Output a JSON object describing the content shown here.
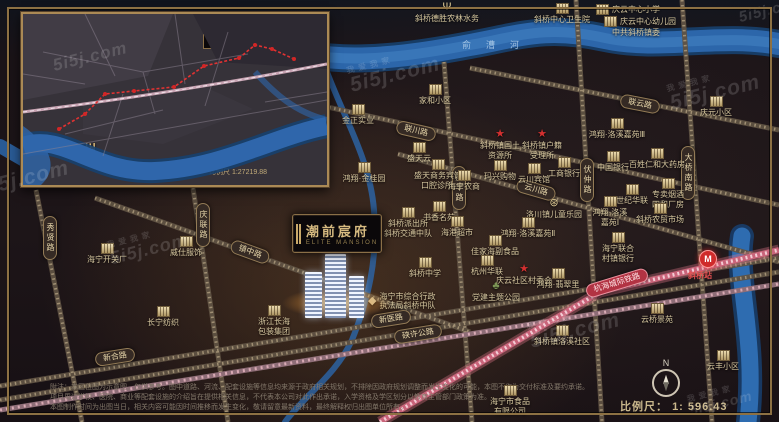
{
  "watermark": {
    "text": "5i5j.com",
    "cn": "我爱我家"
  },
  "inset": {
    "city_top": "海宁",
    "city_bottom": "杭州",
    "scale": "比例尺 1:27219.88",
    "badge": "潮前宸府",
    "compass": "N"
  },
  "project": {
    "badge_cn": "潮前宸府",
    "badge_en": "ELITE MANSION"
  },
  "rivers": {
    "top": "俞漕河"
  },
  "railway": {
    "label": "杭海城际铁路"
  },
  "station": {
    "badge": "M",
    "label": "斜桥站"
  },
  "compass": {
    "label": "N"
  },
  "scalebar": {
    "label": "比例尺：",
    "value": "1: 596.43"
  },
  "roads": {
    "lianyun": "联云路",
    "lianchuan": "联川路",
    "yunchuan": "云川路",
    "zhenzhong": "镇中路",
    "xinhe": "新合路",
    "xinyi": "新医路",
    "xiaxu": "硖许公路",
    "qinglian": "庆联路",
    "xiuxian": "秀贤路",
    "qingfeng": "庆丰路",
    "fuzhong": "伏仲路",
    "daqiaonan": "大桥南路"
  },
  "pois": [
    {
      "l1": "斜桥德胜农林水务"
    },
    {
      "l1": "斜桥中心卫生院"
    },
    {
      "l1": "庆云中心小学"
    },
    {
      "l1": "庆云中心幼儿园"
    },
    {
      "l1": "中共斜桥镇委"
    },
    {
      "l1": "家和小区"
    },
    {
      "l1": "金正实业"
    },
    {
      "l1": "庆元小区"
    },
    {
      "l1": "鸿翔·洛溪嘉苑Ⅲ"
    },
    {
      "l1": "斜桥镇国土",
      "l2": "资源所"
    },
    {
      "l1": "斜桥镇户籍",
      "l2": "受理所"
    },
    {
      "l1": "玛兴购物"
    },
    {
      "l1": "云川宾馆"
    },
    {
      "l1": "工商银行"
    },
    {
      "l1": "中国银行"
    },
    {
      "l1": "百姓仁和大药房"
    },
    {
      "l1": "世纪华联"
    },
    {
      "l1": "专卖烟酒",
      "l2": "四和厂房"
    },
    {
      "l1": "斜桥农贸市场"
    },
    {
      "l1": "鸿翔·洛溪",
      "l2": "嘉苑Ⅰ"
    },
    {
      "l1": "海宁联合",
      "l2": "村镇银行"
    },
    {
      "l1": "洛川镇儿童乐园"
    },
    {
      "l1": "鸿翔·洛溪嘉苑Ⅱ"
    },
    {
      "l1": "佳家海副食品"
    },
    {
      "l1": "杭州华联"
    },
    {
      "l1": "庆云社区村委会"
    },
    {
      "l1": "鸿翔·翡翠里"
    },
    {
      "l1": "党建主题公园"
    },
    {
      "l1": "斜桥中学"
    },
    {
      "l1": "海宁市综合行政",
      "l2": "执法局斜桥中队"
    },
    {
      "l1": "书香名苑"
    },
    {
      "l1": "斜桥派出所",
      "l2": "斜桥交通中队"
    },
    {
      "l1": "海港超市"
    },
    {
      "l1": "口腔诊所"
    },
    {
      "l1": "盛天云"
    },
    {
      "l1": "盛天商务宾馆"
    },
    {
      "l1": "海宁农商"
    },
    {
      "l1": "鸿翔·金桂园"
    },
    {
      "l1": "海宁开关厂"
    },
    {
      "l1": "威仕服饰"
    },
    {
      "l1": "长宁纺织"
    },
    {
      "l1": "浙江长海",
      "l2": "包装集团"
    },
    {
      "l1": "海宁市食品",
      "l2": "有限公司"
    },
    {
      "l1": "斜桥镇洛溪社区"
    },
    {
      "l1": "云桥景苑"
    },
    {
      "l1": "云丰小区"
    }
  ],
  "disclaimer": {
    "line1": "附注：本区位图为示意图，仅供参考。图中道路、河流、配套设施等信息均来源于政府相关规划，不排除因政府规划调整而发生变化的可能，本图不作为交付标准及要约承诺。",
    "line2": "项目周边学校、医院、商业等配套设施的介绍旨在提供相关信息，不代表本公司对此作出承诺，入学资格及学区划分以教育主管部门政策为准。",
    "line3": "本图制作时间为出图当日，相关内容可能因时间推移而发生变化，敬请留意最新资料，最终解释权归出图单位所有。"
  }
}
